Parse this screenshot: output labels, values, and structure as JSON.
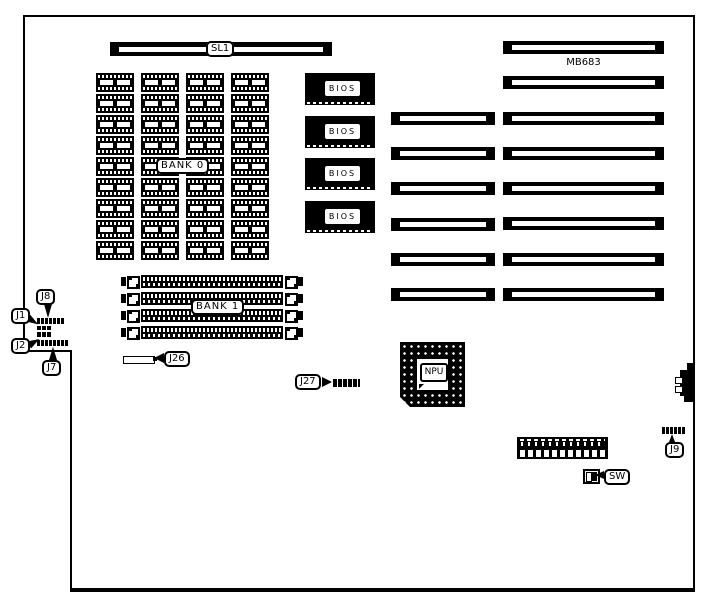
{
  "diagram": {
    "model_text": "MB683",
    "slot1_label": "SL1",
    "bank0_label": "BANK 0",
    "bank1_label": "BANK 1",
    "npu_label": "NPU",
    "switch_label": "SW",
    "bios_chips": [
      {
        "label": "BIOS"
      },
      {
        "label": "BIOS"
      },
      {
        "label": "BIOS"
      },
      {
        "label": "BIOS"
      }
    ],
    "jumpers": {
      "j1": "J1",
      "j2": "J2",
      "j7": "J7",
      "j8": "J8",
      "j9": "J9",
      "j26": "J26",
      "j27": "J27"
    },
    "counts": {
      "dram_chips": 36,
      "simm_sockets": 4,
      "isa_long_slots": 8,
      "isa_short_slots": 6
    },
    "colors": {
      "ink": "#000000",
      "paper": "#ffffff"
    }
  }
}
